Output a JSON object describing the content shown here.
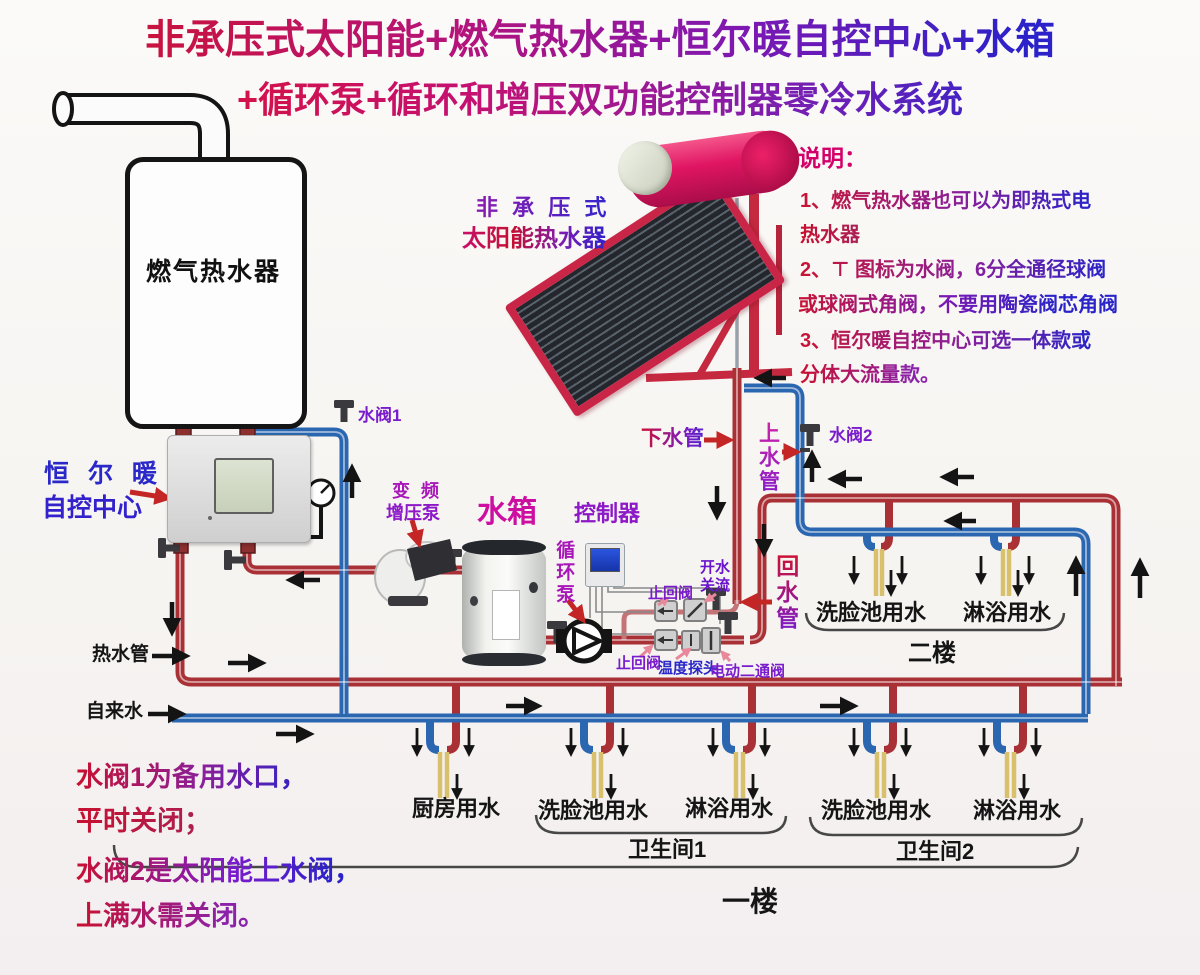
{
  "title": {
    "line1": "非承压式太阳能+燃气热水器+恒尔暖自控中心+水箱",
    "line2": "+循环泵+循环和增压双功能控制器零冷水系统"
  },
  "notes": {
    "heading": "说明：",
    "line1": "1、燃气热水器也可以为即热式电",
    "line2": "热水器",
    "line3": "2、⊤ 图标为水阀，6分全通径球阀",
    "line4": "或球阀式角阀，不要用陶瓷阀芯角阀",
    "line5": "3、恒尔暖自控中心可选一体款或",
    "line6": "分体大流量款。"
  },
  "equipment": {
    "gas_heater": "燃气热水器",
    "solar_line1": "非 承 压 式",
    "solar_line2": "太阳能热水器",
    "hengernuan_line1": "恒 尔 暖",
    "hengernuan_line2": "自控中心",
    "valve1": "水阀1",
    "valve2": "水阀2",
    "booster_line1": "变 频",
    "booster_line2": "增压泵",
    "tank": "水箱",
    "controller": "控制器",
    "circ_pump": "循环泵",
    "check_valve_top": "止回阀",
    "flow_switch_line1": "开水",
    "flow_switch_line2": "关流",
    "check_valve_bottom": "止回阀",
    "temp_probe": "温度探头",
    "motor_valve": "电动二通阀"
  },
  "pipes": {
    "down": "下水管",
    "up": "上水管",
    "return": "回水管",
    "hot": "热水管",
    "cold": "自来水"
  },
  "floor2": {
    "tap1": "洗脸池用水",
    "tap2": "淋浴用水",
    "label": "二楼"
  },
  "floor1": {
    "kitchen": "厨房用水",
    "b1tap1": "洗脸池用水",
    "b1tap2": "淋浴用水",
    "bath1": "卫生间1",
    "b2tap1": "洗脸池用水",
    "b2tap2": "淋浴用水",
    "bath2": "卫生间2",
    "label": "一楼"
  },
  "footnote": {
    "line1": "水阀1为备用水口，",
    "line2": "平时关闭；",
    "line3": "水阀2是太阳能上水阀，",
    "line4": "上满水需关闭。"
  },
  "colors": {
    "hot_pipe": "#a93136",
    "cold_pipe": "#2b66b0",
    "stub_pipe": "#d8c06c",
    "accent_red": "#c42626",
    "label_purple": "#7a1ccc",
    "label_blue": "#2a28c8",
    "magenta": "#cc0fa0"
  }
}
